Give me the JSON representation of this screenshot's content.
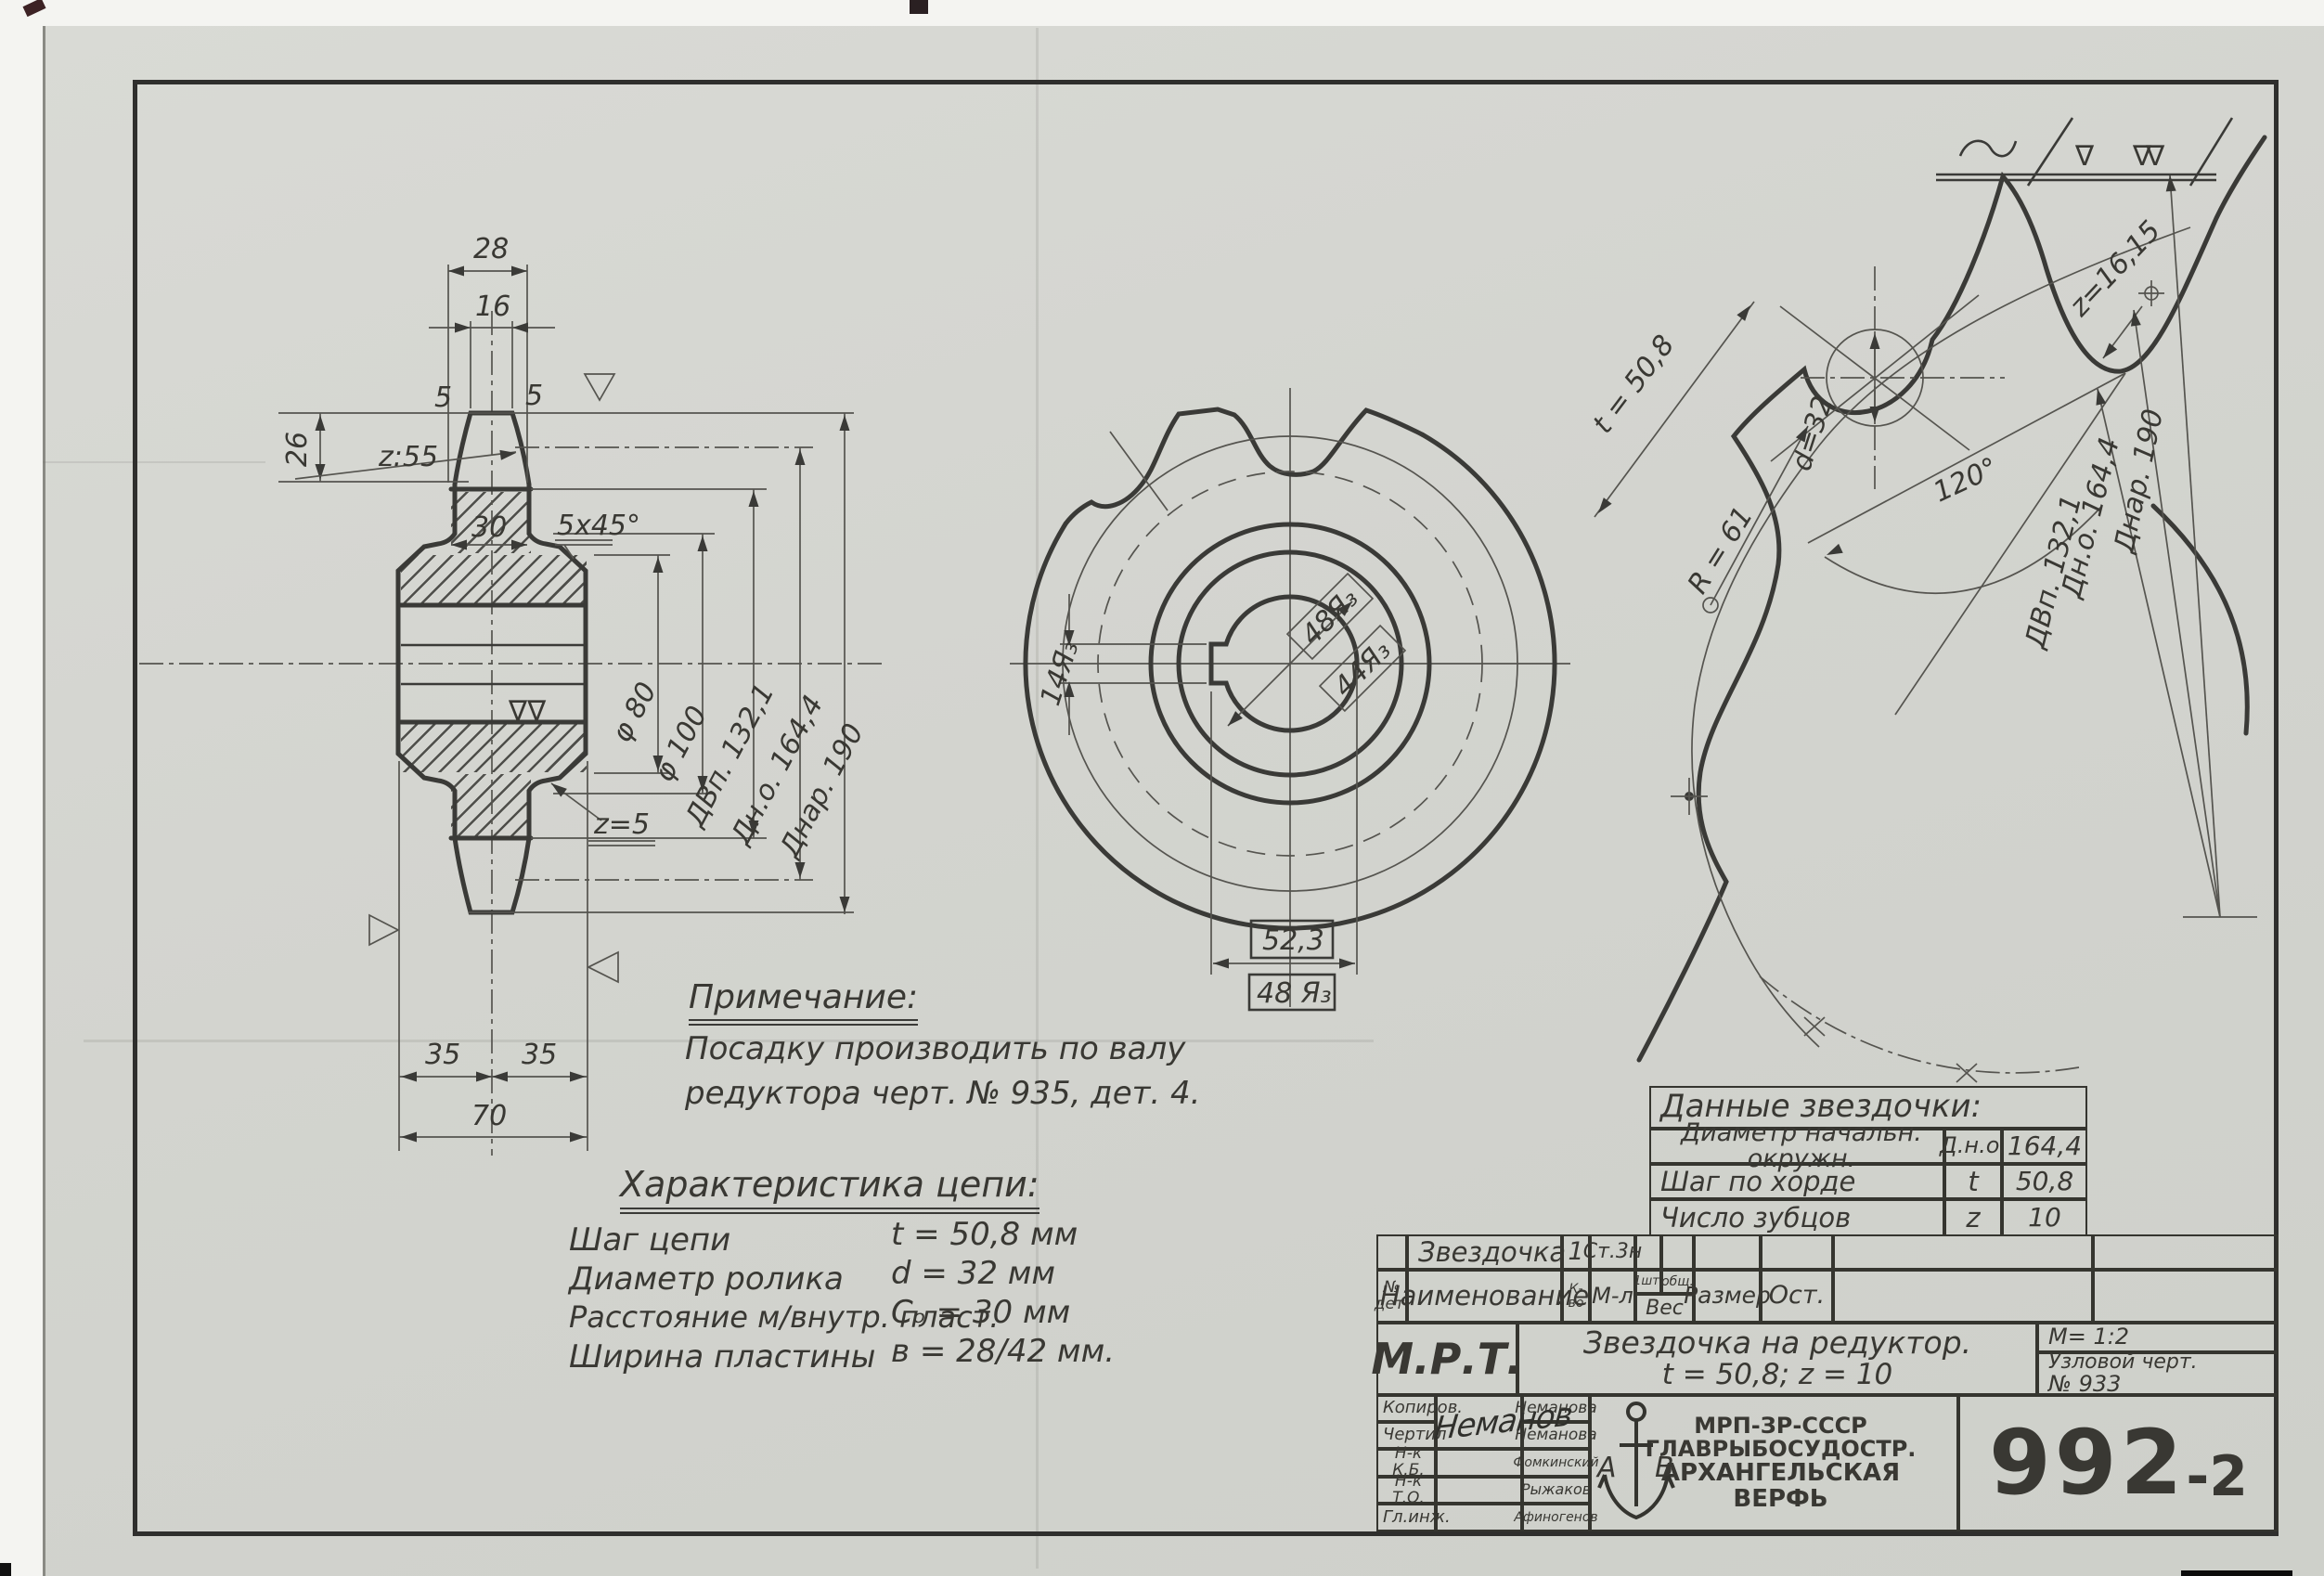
{
  "sheet": {
    "number": "992",
    "number_suffix": "-2"
  },
  "roughness": {
    "t1": "∇",
    "t2": "∇∇"
  },
  "section_view": {
    "dim_w_outer": "28",
    "dim_w_tip": "16",
    "dim_tooth_h": "26",
    "r_flank": "z:55",
    "dim_rim": "30",
    "chamfer": "5x45°",
    "glyph_left": "5",
    "glyph_right": "5",
    "r_fillet": "z=5",
    "d80": "φ 80",
    "d100": "φ 100",
    "d_vp": "ДВп. 132,1",
    "d_no": "Дн.о. 164,4",
    "d_nar": "Днар. 190",
    "dim_35l": "35",
    "dim_35r": "35",
    "dim_70": "70",
    "bore_mark": "∇∇"
  },
  "front_view": {
    "keyway": "14Я₃",
    "fit_d1": "48Я₃",
    "fit_d2": "44Я₃",
    "dim_key": "52,3",
    "fit_bore": "48 Я₃"
  },
  "profile_view": {
    "pitch": "t = 50,8",
    "roller": "d=32",
    "seat_r": "R = 61",
    "angle": "120°",
    "tip_r": "z=16,15",
    "d_vp": "ДВп. 132,1",
    "d_no": "Дн.о. 164,4",
    "d_nar": "Днар. 190"
  },
  "note": {
    "title": "Примечание:",
    "line1": "Посадку производить по валу",
    "line2": "редуктора  черт. № 935, дет. 4."
  },
  "chain": {
    "title": "Характеристика цепи:",
    "rows": [
      {
        "label": "Шаг цепи",
        "value": "t = 50,8 мм"
      },
      {
        "label": "Диаметр ролика",
        "value": "d = 32 мм"
      },
      {
        "label": "Расстояние м/внутр. пласт.",
        "value": "Cₒ = 30 мм"
      },
      {
        "label": "Ширина пластины",
        "value": "в = 28/42 мм."
      }
    ]
  },
  "data_table": {
    "title": "Данные  звездочки:",
    "rows": [
      {
        "label": "Диаметр начальн. окружн.",
        "symbol": "Д.н.о.",
        "value": "164,4"
      },
      {
        "label": "Шаг по хорде",
        "symbol": "t",
        "value": "50,8"
      },
      {
        "label": "Число зубцов",
        "symbol": "z",
        "value": "10"
      }
    ]
  },
  "title_block": {
    "part_name": "Звездочка",
    "part_qty": "1",
    "part_material": "Ст.3н",
    "col_no": "№ дет.",
    "col_name": "Наименование",
    "col_qty": "К-во",
    "col_mat": "М-л",
    "col_w1": "1шт.",
    "col_w2": "общ.",
    "col_weight": "Вес",
    "col_size": "Размер",
    "col_ost": "Ост.",
    "org": "М.Р.Т.",
    "title_line1": "Звездочка на редуктор.",
    "title_line2": "t = 50,8;  z = 10",
    "scale": "М= 1:2",
    "node_ref": "Узловой черт.",
    "node_no": "№  933",
    "signature": "Неманов",
    "sig_rows": [
      {
        "role": "Копиров.",
        "name": "Неманова"
      },
      {
        "role": "Чертил",
        "name": "Неманова"
      },
      {
        "role": "Н-к К.Б.",
        "name": "Фомкинский"
      },
      {
        "role": "Н-к Т.О.",
        "name": "Рыжаков"
      },
      {
        "role": "Гл.инж.",
        "name": "Афиногенов"
      }
    ],
    "logo_left": "А",
    "logo_right": "В",
    "logo_lines": [
      "МРП-ЗР-СССР",
      "ГЛАВРЫБОСУДОСТР.",
      "АРХАНГЕЛЬСКАЯ",
      "ВЕРФЬ"
    ]
  }
}
